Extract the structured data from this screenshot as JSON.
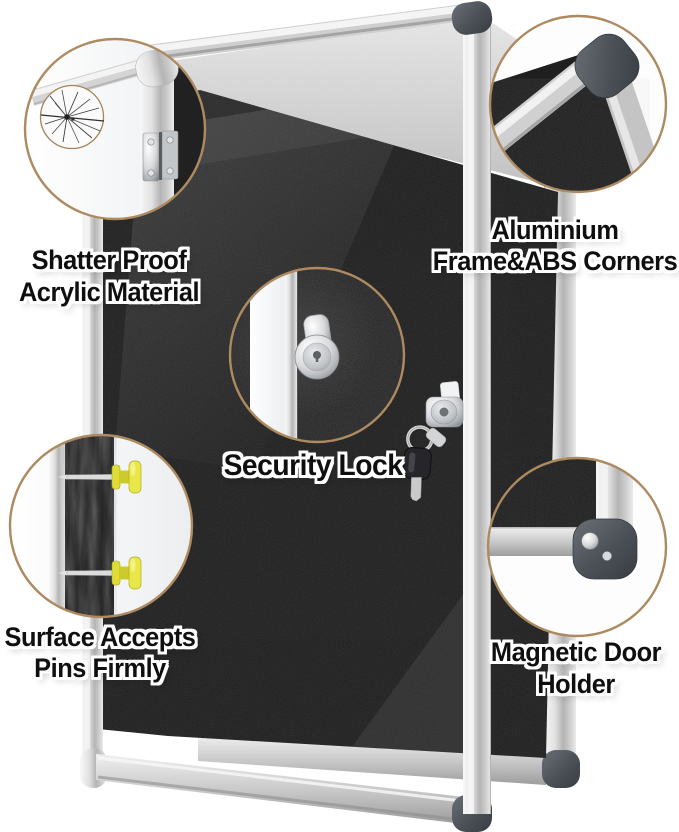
{
  "colors": {
    "background": "#ffffff",
    "felt_surface": "#1e1e1e",
    "frame_silver": "#d6d6d6",
    "abs_corner_gray": "#4a5056",
    "callout_ring_tan": "#ad8a60",
    "push_pin_yellow": "#e8e544",
    "label_text": "#0f0f0f",
    "label_outline": "#ffffff"
  },
  "callouts": [
    {
      "id": "shatter-proof-acrylic",
      "lines": [
        "Shatter Proof",
        "Acrylic Material"
      ]
    },
    {
      "id": "aluminium-frame-abs-corners",
      "lines": [
        "Aluminium",
        "Frame&ABS Corners"
      ]
    },
    {
      "id": "security-lock",
      "lines": [
        "Security Lock"
      ]
    },
    {
      "id": "surface-accepts-pins",
      "lines": [
        "Surface Accepts",
        "Pins Firmly"
      ]
    },
    {
      "id": "magnetic-door-holder",
      "lines": [
        "Magnetic Door",
        "Holder"
      ]
    }
  ]
}
